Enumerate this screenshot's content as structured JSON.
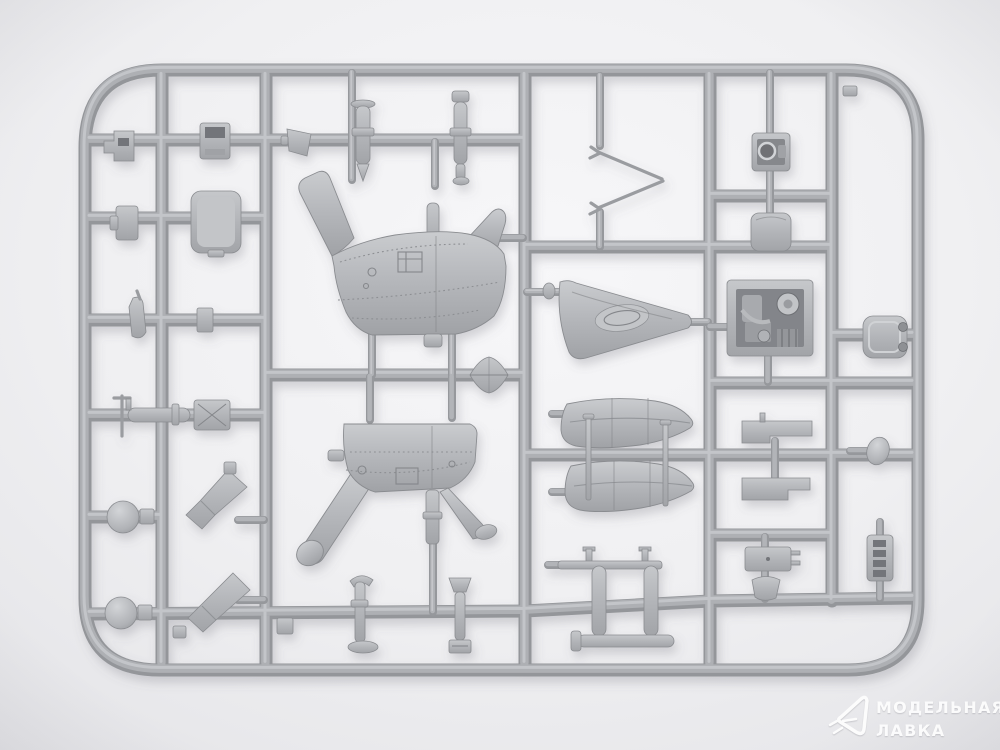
{
  "image": {
    "type": "photograph",
    "subject": "Grey injection-moulded model kit sprue with helicopter parts on a light seamless background"
  },
  "watermark": {
    "line1": "МОДЕЛЬНАЯ",
    "line2": "ЛАВКА",
    "logo": "paper-plane-icon",
    "color": "#ffffff"
  },
  "colors": {
    "background_light": "#f7f7f9",
    "background_dark": "#e0e0e4",
    "plastic": "#aeb0b4",
    "plastic_highlight": "#c7c9cc",
    "plastic_shadow": "#8f9195"
  },
  "parts": [
    "fuselage-half-right",
    "fuselage-half-left",
    "v-shaped-antenna",
    "tail-fin",
    "float-half-top",
    "float-half-bottom",
    "float-struts",
    "engine-block",
    "instrument-box",
    "equipment-box",
    "radiator-panel",
    "flat-plate-top",
    "flat-plate-bottom",
    "egg-knob",
    "control-panel",
    "winglet",
    "ladder-strip",
    "ball-float-1",
    "ball-float-2",
    "exhaust-chute-1",
    "exhaust-chute-2",
    "cockpit-door",
    "slotted-box",
    "clip-bracket",
    "small-block",
    "strut-blade",
    "torpedo-fairing",
    "crossed-box",
    "cylinder-bomb-1",
    "cylinder-bomb-2",
    "wedge-part",
    "skid-frame",
    "skid-bar",
    "mast-part-1",
    "mast-part-2",
    "sprue-gate-diamond"
  ]
}
